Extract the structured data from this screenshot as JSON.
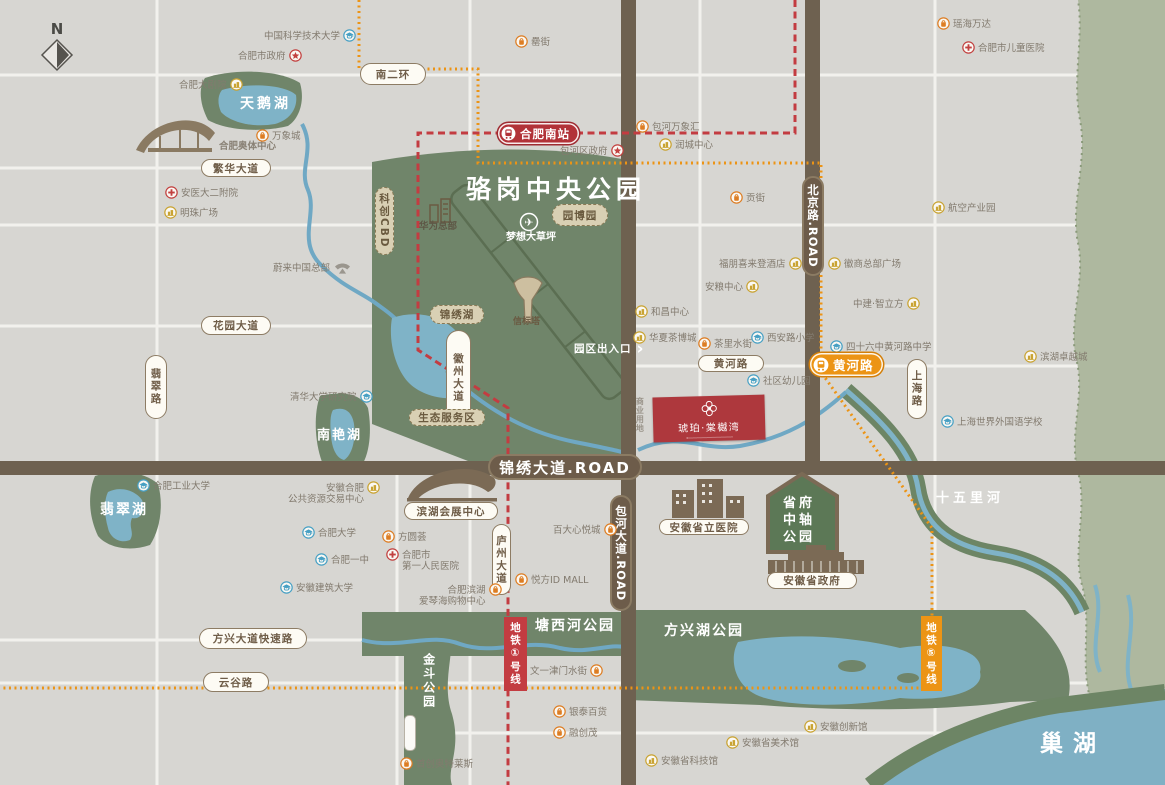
{
  "compass": {
    "label": "N"
  },
  "park": {
    "title": "骆岗中央公园"
  },
  "project": {
    "name": "琥珀·棠樾湾"
  },
  "stations": {
    "south_label": "合肥南站",
    "huanghe_label": "黄河路"
  },
  "metro_labels": {
    "line1": "地铁①号线",
    "line5": "地铁⑤号线"
  },
  "entrance": {
    "label": "园区出入口",
    "chevron": "›"
  },
  "icon_colors": {
    "shop": "#dd7d23",
    "biz": "#c9a332",
    "school": "#47a0c4",
    "cross": "#c2403f",
    "star": "#c2403f",
    "nio": "#9a968e",
    "metro_red": "#c33c41",
    "metro_orange": "#ec9415"
  },
  "pills": [
    {
      "t": "南二环",
      "x": 360,
      "y": 63,
      "w": 66,
      "h": 22,
      "s": "w",
      "n": "nanerhuan-road"
    },
    {
      "t": "繁华大道",
      "x": 201,
      "y": 159,
      "w": 70,
      "h": 18,
      "s": "w",
      "n": "fanhua-avenue"
    },
    {
      "t": "花园大道",
      "x": 201,
      "y": 316,
      "w": 70,
      "h": 19,
      "s": "w",
      "n": "huayuan-avenue"
    },
    {
      "t": "黄河路",
      "x": 698,
      "y": 355,
      "w": 66,
      "h": 17,
      "s": "w",
      "n": "huanghe-road"
    },
    {
      "t": "方兴大道快速路",
      "x": 199,
      "y": 628,
      "w": 108,
      "h": 21,
      "s": "w",
      "n": "fangxing-expressway"
    },
    {
      "t": "云谷路",
      "x": 203,
      "y": 672,
      "w": 66,
      "h": 20,
      "s": "w",
      "n": "yungu-road"
    },
    {
      "t": "翡翠路",
      "x": 145,
      "y": 355,
      "w": 22,
      "h": 64,
      "s": "w",
      "v": 1,
      "n": "feicui-road"
    },
    {
      "t": "徽州大道",
      "x": 446,
      "y": 330,
      "w": 25,
      "h": 95,
      "s": "w",
      "v": 1,
      "n": "huizhou-avenue"
    },
    {
      "t": "庐州大道",
      "x": 492,
      "y": 524,
      "w": 19,
      "h": 71,
      "s": "w",
      "v": 1,
      "n": "luzhou-avenue"
    },
    {
      "t": "上海路",
      "x": 907,
      "y": 359,
      "w": 20,
      "h": 60,
      "s": "w",
      "v": 1,
      "n": "shanghai-road"
    },
    {
      "t": "科创CBD",
      "x": 375,
      "y": 187,
      "w": 19,
      "h": 68,
      "s": "b",
      "v": 1,
      "n": "kechuang-cbd"
    },
    {
      "t": "园博园",
      "x": 552,
      "y": 204,
      "w": 56,
      "h": 22,
      "s": "b",
      "n": "yuanboyuan"
    },
    {
      "t": "锦绣湖",
      "x": 430,
      "y": 305,
      "w": 54,
      "h": 19,
      "s": "b",
      "n": "jinxiu-lake-pill"
    },
    {
      "t": "生态服务区",
      "x": 409,
      "y": 409,
      "w": 76,
      "h": 17,
      "s": "b",
      "n": "eco-service-zone"
    },
    {
      "t": "滨湖会展中心",
      "x": 404,
      "y": 502,
      "w": 94,
      "h": 18,
      "s": "w",
      "n": "binhu-expo-center"
    },
    {
      "t": "安徽省立医院",
      "x": 659,
      "y": 519,
      "w": 90,
      "h": 16,
      "s": "w",
      "n": "anhui-provincial-hospital"
    },
    {
      "t": "安徽省政府",
      "x": 767,
      "y": 572,
      "w": 90,
      "h": 17,
      "s": "w",
      "n": "anhui-provincial-government"
    },
    {
      "t": "锦绣大道.ROAD",
      "x": 488,
      "y": 454,
      "w": 154,
      "h": 26,
      "s": "br",
      "n": "jinxiu-avenue-plate"
    },
    {
      "t": "北京路.ROAD",
      "x": 802,
      "y": 176,
      "w": 22,
      "h": 100,
      "s": "br",
      "v": 1,
      "n": "beijing-road-plate"
    },
    {
      "t": "包河大道.ROAD",
      "x": 610,
      "y": 495,
      "w": 22,
      "h": 116,
      "s": "br",
      "v": 1,
      "n": "baohe-avenue-plate"
    }
  ],
  "labels": [
    {
      "t": "天鹅湖",
      "x": 240,
      "y": 95,
      "fs": 14,
      "ls": 3,
      "n": "swan-lake-label"
    },
    {
      "t": "骆岗中央公园",
      "x": 466,
      "y": 174,
      "fs": 25,
      "ls": 5,
      "n": "luogang-park-title"
    },
    {
      "t": "南艳湖",
      "x": 317,
      "y": 428,
      "fs": 13,
      "ls": 2,
      "n": "nanyan-lake-label"
    },
    {
      "t": "翡翠湖",
      "x": 100,
      "y": 501,
      "fs": 14,
      "ls": 2,
      "n": "feicui-lake-label"
    },
    {
      "t": "塘西河公园",
      "x": 535,
      "y": 617,
      "fs": 14,
      "ls": 2,
      "n": "tangxihe-park-label"
    },
    {
      "t": "方兴湖公园",
      "x": 664,
      "y": 622,
      "fs": 14,
      "ls": 2,
      "n": "fangxinghu-park-label"
    },
    {
      "t": "金斗公园",
      "x": 420,
      "y": 653,
      "fs": 12,
      "ls": 2,
      "v": 1,
      "n": "jindou-park-label"
    },
    {
      "t": "十五里河",
      "x": 936,
      "y": 491,
      "fs": 13,
      "ls": 4,
      "n": "shiwuli-river-label"
    },
    {
      "t": "巢湖",
      "x": 1040,
      "y": 730,
      "fs": 23,
      "ls": 10,
      "n": "chao-lake-label"
    },
    {
      "t": "省府\n中轴\n公园",
      "x": 783,
      "y": 496,
      "fs": 13,
      "ls": 3,
      "n": "provincial-axis-park-label"
    },
    {
      "t": "华为总部",
      "x": 419,
      "y": 221,
      "fs": 9.5,
      "ls": 0,
      "c": "#5e5746",
      "n": "huawei-hq-label"
    },
    {
      "t": "梦想大草坪",
      "x": 506,
      "y": 231,
      "fs": 10,
      "ls": 0,
      "n": "dream-lawn-label"
    },
    {
      "t": "信标塔",
      "x": 513,
      "y": 317,
      "fs": 9,
      "ls": 0,
      "c": "#6a5a42",
      "n": "beacon-tower-label"
    },
    {
      "t": "合肥奥体中心",
      "x": 219,
      "y": 141,
      "fs": 9.5,
      "ls": 0,
      "c": "#8a8276",
      "n": "olympic-center-label"
    },
    {
      "t": "商业用地",
      "x": 634,
      "y": 397,
      "fs": 8,
      "ls": 1,
      "c": "#9a948a",
      "v": 1,
      "n": "commercial-land-label"
    }
  ],
  "pois": [
    {
      "t": "中国科学技术大学",
      "ic": "school",
      "x": 264,
      "y": 29,
      "side": "r"
    },
    {
      "t": "合肥市政府",
      "ic": "star",
      "x": 238,
      "y": 49,
      "side": "r"
    },
    {
      "t": "瑶海万达",
      "ic": "shop",
      "x": 937,
      "y": 17,
      "side": "l"
    },
    {
      "t": "合肥市儿童医院",
      "ic": "cross",
      "x": 962,
      "y": 41,
      "side": "l"
    },
    {
      "t": "罍街",
      "ic": "shop",
      "x": 515,
      "y": 35,
      "side": "l"
    },
    {
      "t": "合肥大剧院",
      "ic": "biz",
      "x": 179,
      "y": 78,
      "side": "r"
    },
    {
      "t": "万象城",
      "ic": "shop",
      "x": 256,
      "y": 129,
      "side": "l"
    },
    {
      "t": "安医大二附院",
      "ic": "cross",
      "x": 165,
      "y": 186,
      "side": "l"
    },
    {
      "t": "明珠广场",
      "ic": "biz",
      "x": 164,
      "y": 206,
      "side": "l"
    },
    {
      "t": "蔚来中国总部",
      "ic": "nio",
      "x": 273,
      "y": 261,
      "side": "r"
    },
    {
      "t": "包河万象汇",
      "ic": "shop",
      "x": 636,
      "y": 120,
      "side": "l"
    },
    {
      "t": "润城中心",
      "ic": "biz",
      "x": 659,
      "y": 138,
      "side": "l"
    },
    {
      "t": "包河区政府",
      "ic": "star",
      "x": 560,
      "y": 144,
      "side": "r"
    },
    {
      "t": "贡街",
      "ic": "shop",
      "x": 730,
      "y": 191,
      "side": "l"
    },
    {
      "t": "航空产业园",
      "ic": "biz",
      "x": 932,
      "y": 201,
      "side": "l"
    },
    {
      "t": "福朋喜来登酒店",
      "ic": "biz",
      "x": 719,
      "y": 257,
      "side": "r"
    },
    {
      "t": "安粮中心",
      "ic": "biz",
      "x": 705,
      "y": 280,
      "side": "r"
    },
    {
      "t": "徽商总部广场",
      "ic": "biz",
      "x": 828,
      "y": 257,
      "side": "l"
    },
    {
      "t": "中建·智立方",
      "ic": "biz",
      "x": 853,
      "y": 297,
      "side": "r"
    },
    {
      "t": "西安路小学",
      "ic": "school",
      "x": 751,
      "y": 331,
      "side": "l"
    },
    {
      "t": "四十六中黄河路中学",
      "ic": "school",
      "x": 830,
      "y": 340,
      "side": "l"
    },
    {
      "t": "茶里水街",
      "ic": "shop",
      "x": 698,
      "y": 337,
      "side": "l"
    },
    {
      "t": "社区幼儿园",
      "ic": "school",
      "x": 747,
      "y": 374,
      "side": "l"
    },
    {
      "t": "和昌中心",
      "ic": "biz",
      "x": 635,
      "y": 305,
      "side": "l"
    },
    {
      "t": "华夏茶博城",
      "ic": "biz",
      "x": 633,
      "y": 331,
      "side": "l"
    },
    {
      "t": "滨湖卓越城",
      "ic": "biz",
      "x": 1024,
      "y": 350,
      "side": "l"
    },
    {
      "t": "上海世界外国语学校",
      "ic": "school",
      "x": 941,
      "y": 415,
      "side": "l"
    },
    {
      "t": "清华大学研究院",
      "ic": "school",
      "x": 290,
      "y": 390,
      "side": "r"
    },
    {
      "t": "合肥工业大学",
      "ic": "school",
      "x": 137,
      "y": 479,
      "side": "l"
    },
    {
      "ln": [
        "安徽合肥",
        "公共资源交易中心"
      ],
      "ic": "biz",
      "x": 288,
      "y": 481,
      "side": "r",
      "al": "r"
    },
    {
      "t": "合肥大学",
      "ic": "school",
      "x": 302,
      "y": 526,
      "side": "l"
    },
    {
      "t": "合肥一中",
      "ic": "school",
      "x": 315,
      "y": 553,
      "side": "l"
    },
    {
      "t": "安徽建筑大学",
      "ic": "school",
      "x": 280,
      "y": 581,
      "side": "l"
    },
    {
      "t": "方圆荟",
      "ic": "shop",
      "x": 382,
      "y": 530,
      "side": "l"
    },
    {
      "ln": [
        "合肥市",
        "第一人民医院"
      ],
      "ic": "cross",
      "x": 386,
      "y": 548,
      "side": "l"
    },
    {
      "ln": [
        "合肥滨湖",
        "爱琴海购物中心"
      ],
      "ic": "shop",
      "x": 419,
      "y": 583,
      "side": "r",
      "al": "r"
    },
    {
      "t": "百大心悦城",
      "ic": "shop",
      "x": 553,
      "y": 523,
      "side": "r"
    },
    {
      "t": "悦方ID MALL",
      "ic": "shop",
      "x": 515,
      "y": 573,
      "side": "l"
    },
    {
      "t": "文一津门水街",
      "ic": "shop",
      "x": 530,
      "y": 664,
      "side": "r"
    },
    {
      "t": "银泰百货",
      "ic": "shop",
      "x": 553,
      "y": 705,
      "side": "l"
    },
    {
      "t": "融创茂",
      "ic": "shop",
      "x": 553,
      "y": 726,
      "side": "l"
    },
    {
      "t": "安徽省科技馆",
      "ic": "biz",
      "x": 645,
      "y": 754,
      "side": "l"
    },
    {
      "t": "安徽省美术馆",
      "ic": "biz",
      "x": 726,
      "y": 736,
      "side": "l"
    },
    {
      "t": "安徽创新馆",
      "ic": "biz",
      "x": 804,
      "y": 720,
      "side": "l"
    },
    {
      "t": "首创奥特莱斯",
      "ic": "shop",
      "x": 400,
      "y": 757,
      "side": "l"
    }
  ]
}
